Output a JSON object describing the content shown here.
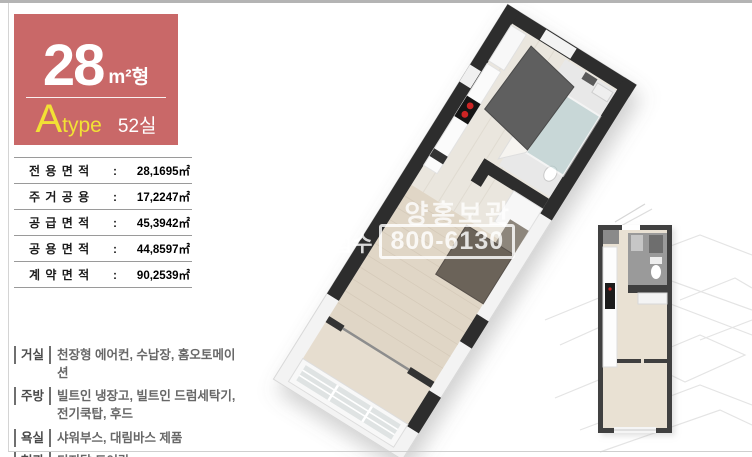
{
  "badge": {
    "area_value": "28",
    "area_suffix": "m²형",
    "type_letter": "A",
    "type_word": "type",
    "unit_count": "52실"
  },
  "area_table": {
    "colon": ":",
    "rows": [
      {
        "label": "전 용 면 적",
        "value": "28,1695㎡"
      },
      {
        "label": "주 거 공 용",
        "value": "17,2247㎡"
      },
      {
        "label": "공 급 면 적",
        "value": "45,3942㎡"
      },
      {
        "label": "공 용 면 적",
        "value": "44,8597㎡"
      },
      {
        "label": "계 약 면 적",
        "value": "90,2539㎡"
      }
    ]
  },
  "features": [
    {
      "label": "거실",
      "text": "천장형 에어컨, 수납장, 홈오토메이션"
    },
    {
      "label": "주방",
      "text": "빌트인 냉장고, 빌트인 드럼세탁기, 전기쿡탑, 후드"
    },
    {
      "label": "욕실",
      "text": "샤워부스, 대림바스 제품"
    },
    {
      "label": "현관",
      "text": "디지탈 도어락"
    }
  ],
  "watermark": {
    "line1": "양홍보관",
    "line2_prefix": "접수",
    "phone": "800-6130"
  },
  "colors": {
    "badge_bg": "#c96868",
    "accent_yellow": "#f2e135",
    "wall_dark": "#2d2d2d",
    "floor_wood": "#e0d6c6",
    "floor_tile": "#eae6de",
    "frame_gray": "#b4b4b4"
  }
}
